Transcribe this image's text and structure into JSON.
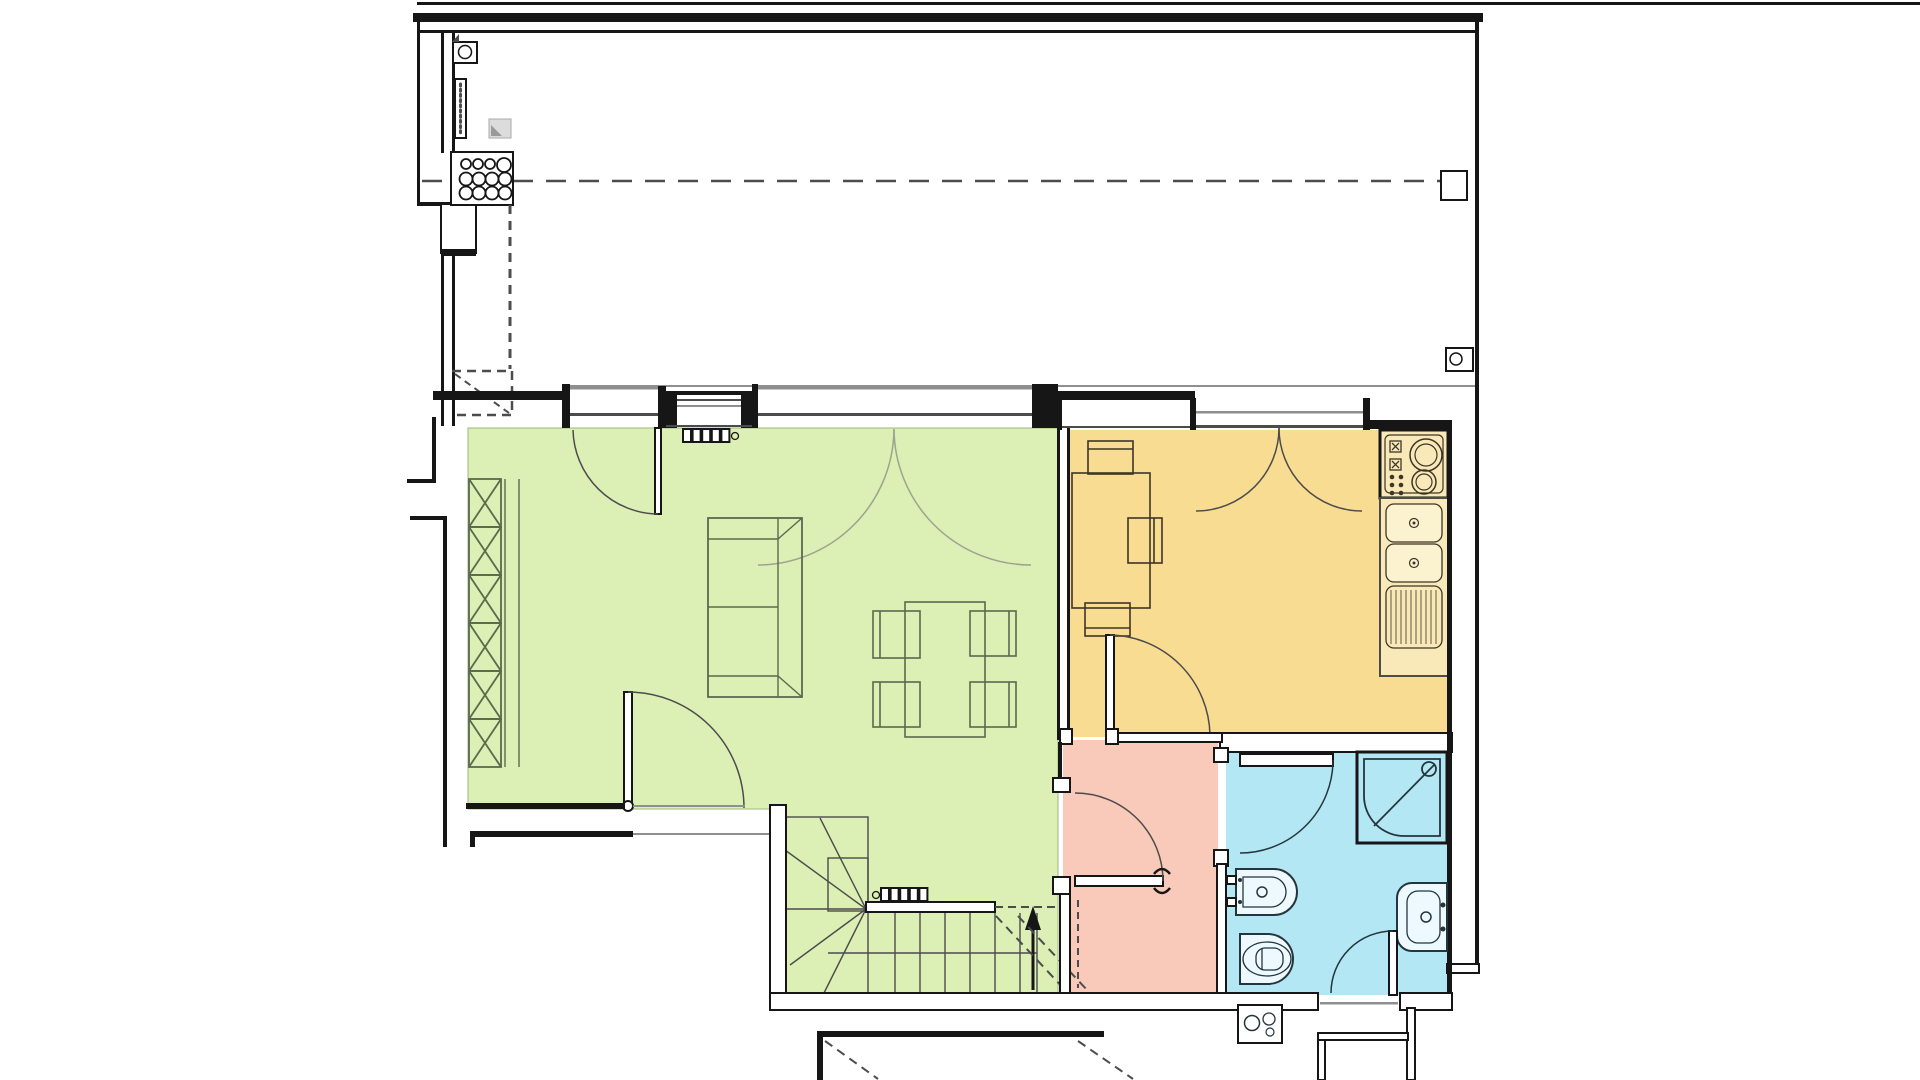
{
  "document": {
    "title": "Apartment upper-floor plan",
    "type": "architectural floor plan drawing",
    "visible_text": [],
    "scale_labels": []
  },
  "colors": {
    "paper": "#ffffff",
    "wall": "#161616",
    "mid": "#4c4c4c",
    "grey": "#8f8f8f",
    "living": "#dcefb4",
    "livline": "#5a6a4e",
    "arcgrey": "#9aa58e",
    "kitchen": "#f8dc92",
    "kitfix": "#f9e9b8",
    "kitbasin": "#fbf2cf",
    "kitline": "#3d3526",
    "hall": "#f9c9b9",
    "bath": "#b4e7f4",
    "bathfix": "#eef9fd",
    "bathline": "#25353d"
  },
  "rooms": [
    {
      "id": "terrace",
      "label": "terrace / roof area",
      "fill": "#ffffff",
      "features": [
        "dashed-axis-line",
        "skylight-circle-grid",
        "gas-meter-box",
        "vent-strip",
        "shaft-dashed-outline"
      ]
    },
    {
      "id": "living-room",
      "label": "living room",
      "fill": "#dcefb4",
      "furniture": [
        "bookshelf-x-pattern",
        "two-seat-sofa",
        "dining-table",
        "four-dining-chairs",
        "radiator",
        "french-window-door",
        "double-balcony-door",
        "door-to-stairs-landing"
      ]
    },
    {
      "id": "kitchen",
      "label": "kitchen",
      "fill": "#f8dc92",
      "furniture": [
        "kitchen-table",
        "three-chairs",
        "cooktop-two-burners",
        "double-sink",
        "drainboard-counter",
        "double-balcony-door",
        "door-to-hallway"
      ]
    },
    {
      "id": "hallway",
      "label": "hallway",
      "fill": "#f9c9b9",
      "furniture": [
        "door-to-living-area",
        "door-to-bathroom",
        "dashed-headroom-line"
      ]
    },
    {
      "id": "bathroom",
      "label": "bathroom",
      "fill": "#b4e7f4",
      "furniture": [
        "corner-shower",
        "bidet",
        "toilet",
        "washbasin",
        "exterior-door",
        "boiler-unit-outside"
      ]
    },
    {
      "id": "staircase",
      "label": "winder staircase going down",
      "fill": "#dcefb4",
      "features": [
        "winder-treads-fan",
        "straight-treads",
        "handrail",
        "walking-line",
        "up-arrow",
        "break-dashed-lines",
        "radiator"
      ]
    },
    {
      "id": "lower-level",
      "label": "structures below shown cut",
      "features": [
        "garage-outline",
        "dashed-diagonals",
        "entry-steps"
      ]
    }
  ]
}
